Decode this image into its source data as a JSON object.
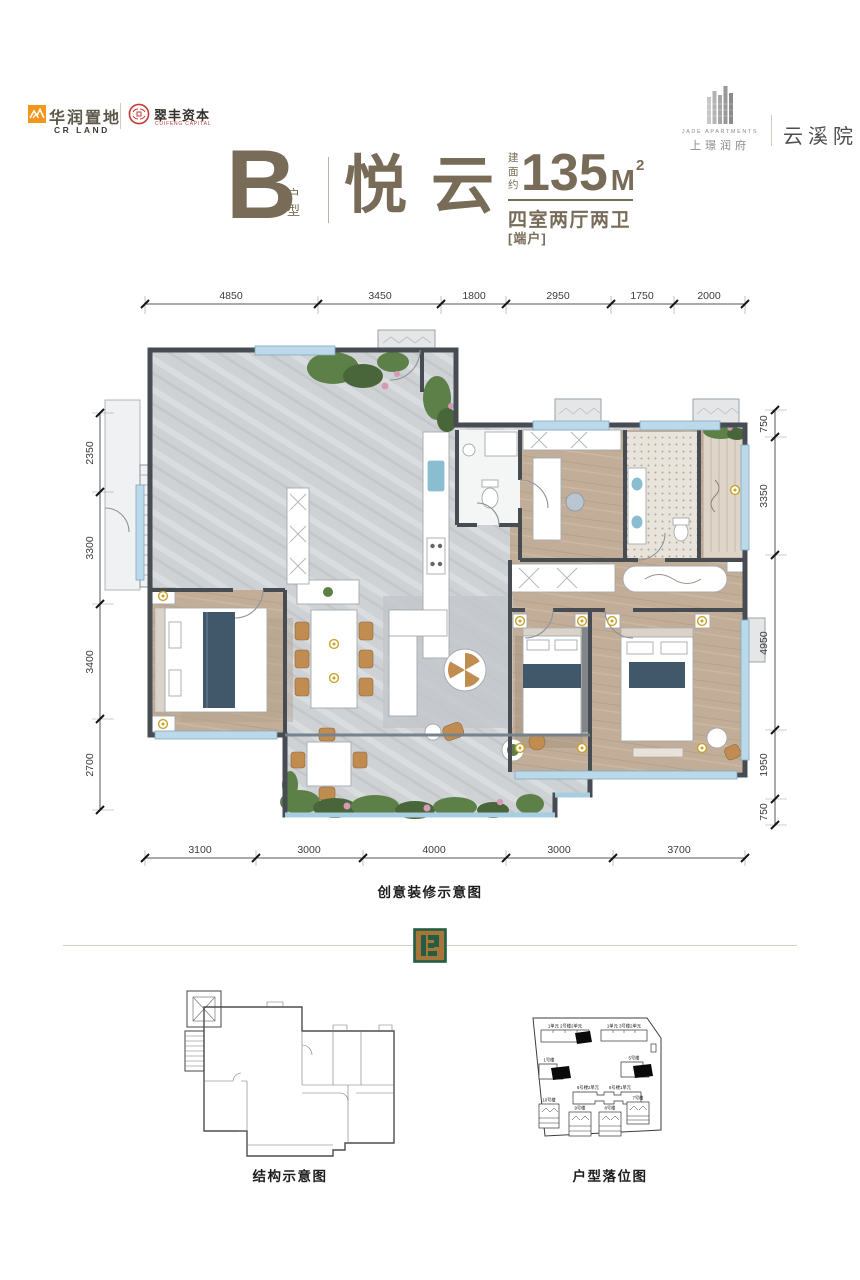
{
  "header": {
    "crland_cn": "华润置地",
    "crland_en": "CR LAND",
    "cuifeng_cn": "翠丰资本",
    "cuifeng_en": "CUIFENG CAPITAL",
    "jade_en": "JADE APARTMENTS",
    "jade_cn": "上璟润府",
    "project": "云溪院"
  },
  "title": {
    "unit": "B",
    "unit_suffix": "户型",
    "name": "悦云",
    "area_label": "建面约",
    "area_value": "135",
    "area_unit": "M",
    "area_exp": "2",
    "rooms": "四室两厅两卫",
    "tag": "[端户]"
  },
  "floorplan": {
    "caption": "创意装修示意图",
    "dims_top": [
      "4850",
      "3450",
      "1800",
      "2950",
      "1750",
      "2000"
    ],
    "dims_left": [
      "2350",
      "3300",
      "3400",
      "2700"
    ],
    "dims_right": [
      "750",
      "3350",
      "4950",
      "1950",
      "750"
    ],
    "dims_bottom": [
      "3100",
      "3000",
      "4000",
      "3000",
      "3700"
    ]
  },
  "structure": {
    "caption": "结构示意图"
  },
  "siteplan": {
    "caption": "户型落位图",
    "labels": {
      "b2": "1单元 2号楼2单元",
      "b3": "1单元 3号楼2单元",
      "b1": "1号楼",
      "b5": "5号楼",
      "b6a": "6号楼2单元",
      "b6b": "6号楼1单元",
      "b10": "10号楼",
      "b9": "9号楼",
      "b8": "8号楼",
      "b7": "7号楼"
    }
  },
  "colors": {
    "accent": "#786c59",
    "crland_orange": "#f2971d",
    "seal_red": "#c23b34",
    "wall": "#474c52",
    "wood": "#c2ae98",
    "tile": "#ced2d5",
    "window": "#bcd9e9"
  }
}
